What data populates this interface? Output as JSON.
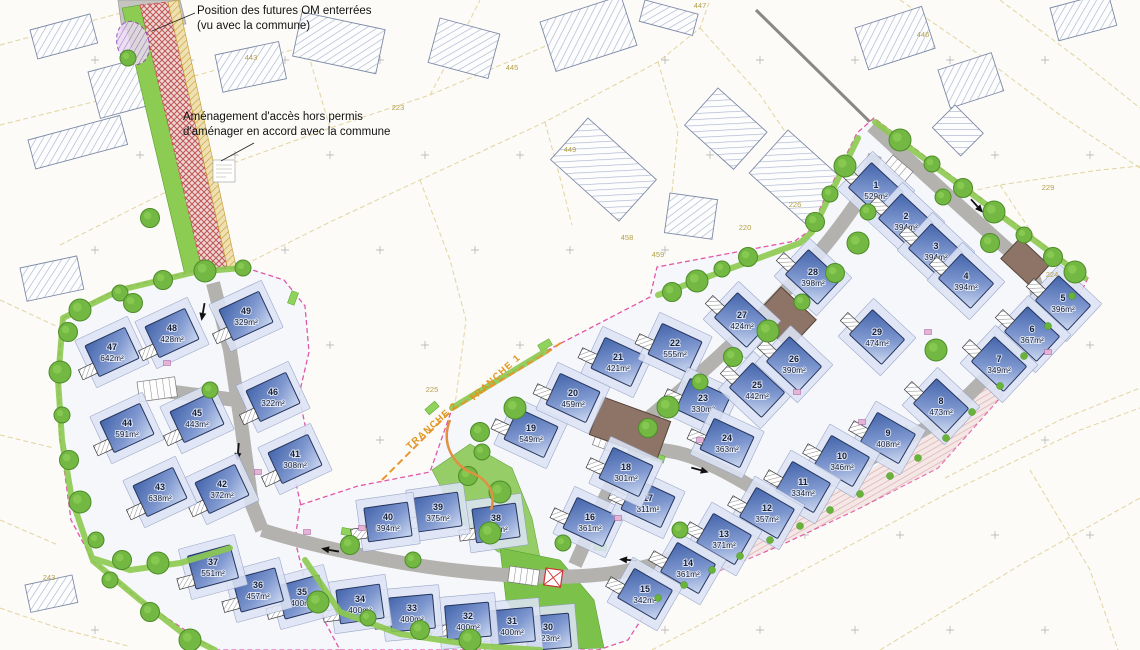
{
  "annotations": {
    "om_line1": "Position des futures OM enterrées",
    "om_line2": "(vu avec la commune)",
    "access_line1": "Aménagement d'accès hors permis",
    "access_line2": "d'aménager en accord avec la commune"
  },
  "area_unit": "m²",
  "tranches": [
    {
      "label": "TRANCHE 1",
      "x": 497,
      "y": 380,
      "rot": -42
    },
    {
      "label": "TRANCHE 2",
      "x": 434,
      "y": 428,
      "rot": -42
    }
  ],
  "lots": [
    {
      "n": 1,
      "area": 529,
      "x": 876,
      "y": 190,
      "r": 43
    },
    {
      "n": 2,
      "area": 394,
      "x": 906,
      "y": 221,
      "r": 43
    },
    {
      "n": 3,
      "area": 394,
      "x": 936,
      "y": 251,
      "r": 43
    },
    {
      "n": 4,
      "area": 394,
      "x": 966,
      "y": 281,
      "r": 43
    },
    {
      "n": 5,
      "area": 396,
      "x": 1063,
      "y": 303,
      "r": 43
    },
    {
      "n": 6,
      "area": 367,
      "x": 1032,
      "y": 334,
      "r": 43
    },
    {
      "n": 7,
      "area": 349,
      "x": 999,
      "y": 364,
      "r": 43
    },
    {
      "n": 8,
      "area": 473,
      "x": 941,
      "y": 406,
      "r": 43
    },
    {
      "n": 9,
      "area": 408,
      "x": 888,
      "y": 438,
      "r": 30
    },
    {
      "n": 10,
      "area": 346,
      "x": 842,
      "y": 461,
      "r": 30
    },
    {
      "n": 11,
      "area": 334,
      "x": 803,
      "y": 487,
      "r": 30
    },
    {
      "n": 12,
      "area": 357,
      "x": 767,
      "y": 513,
      "r": 30
    },
    {
      "n": 13,
      "area": 371,
      "x": 724,
      "y": 539,
      "r": 30
    },
    {
      "n": 14,
      "area": 361,
      "x": 688,
      "y": 568,
      "r": 30
    },
    {
      "n": 15,
      "area": 342,
      "x": 645,
      "y": 594,
      "r": 30
    },
    {
      "n": 16,
      "area": 361,
      "x": 590,
      "y": 522,
      "r": 25
    },
    {
      "n": 17,
      "area": 311,
      "x": 648,
      "y": 503,
      "r": 25
    },
    {
      "n": 18,
      "area": 301,
      "x": 626,
      "y": 472,
      "r": 25
    },
    {
      "n": 19,
      "area": 549,
      "x": 531,
      "y": 433,
      "r": 25
    },
    {
      "n": 20,
      "area": 459,
      "x": 573,
      "y": 398,
      "r": 25
    },
    {
      "n": 21,
      "area": 421,
      "x": 618,
      "y": 362,
      "r": 25
    },
    {
      "n": 22,
      "area": 555,
      "x": 675,
      "y": 348,
      "r": 25
    },
    {
      "n": 23,
      "area": 330,
      "x": 703,
      "y": 403,
      "r": 25
    },
    {
      "n": 24,
      "area": 363,
      "x": 727,
      "y": 443,
      "r": 25
    },
    {
      "n": 25,
      "area": 442,
      "x": 757,
      "y": 390,
      "r": 43
    },
    {
      "n": 26,
      "area": 390,
      "x": 794,
      "y": 364,
      "r": 43
    },
    {
      "n": 27,
      "area": 424,
      "x": 742,
      "y": 320,
      "r": 43
    },
    {
      "n": 28,
      "area": 398,
      "x": 813,
      "y": 277,
      "r": 43
    },
    {
      "n": 29,
      "area": 474,
      "x": 877,
      "y": 337,
      "r": 43
    },
    {
      "n": 30,
      "area": 423,
      "x": 548,
      "y": 632,
      "r": -5
    },
    {
      "n": 31,
      "area": 400,
      "x": 512,
      "y": 626,
      "r": -5
    },
    {
      "n": 32,
      "area": 400,
      "x": 468,
      "y": 621,
      "r": -5
    },
    {
      "n": 33,
      "area": 400,
      "x": 412,
      "y": 613,
      "r": -5
    },
    {
      "n": 34,
      "area": 400,
      "x": 360,
      "y": 604,
      "r": -8
    },
    {
      "n": 35,
      "area": 400,
      "x": 302,
      "y": 597,
      "r": -15
    },
    {
      "n": 36,
      "area": 457,
      "x": 258,
      "y": 590,
      "r": -15
    },
    {
      "n": 37,
      "area": 551,
      "x": 213,
      "y": 567,
      "r": -15
    },
    {
      "n": 38,
      "area": 432,
      "x": 496,
      "y": 523,
      "r": -8
    },
    {
      "n": 39,
      "area": 375,
      "x": 438,
      "y": 512,
      "r": -8
    },
    {
      "n": 40,
      "area": 394,
      "x": 388,
      "y": 522,
      "r": -8
    },
    {
      "n": 41,
      "area": 308,
      "x": 295,
      "y": 459,
      "r": -25
    },
    {
      "n": 42,
      "area": 372,
      "x": 222,
      "y": 489,
      "r": -25
    },
    {
      "n": 43,
      "area": 638,
      "x": 160,
      "y": 492,
      "r": -25
    },
    {
      "n": 44,
      "area": 591,
      "x": 127,
      "y": 428,
      "r": -25
    },
    {
      "n": 45,
      "area": 443,
      "x": 197,
      "y": 418,
      "r": -25
    },
    {
      "n": 46,
      "area": 322,
      "x": 273,
      "y": 397,
      "r": -25
    },
    {
      "n": 47,
      "area": 642,
      "x": 112,
      "y": 352,
      "r": -25
    },
    {
      "n": 48,
      "area": 428,
      "x": 172,
      "y": 333,
      "r": -25
    },
    {
      "n": 49,
      "area": 329,
      "x": 246,
      "y": 316,
      "r": -25
    }
  ],
  "parcels": [
    {
      "label": "443",
      "x": 251,
      "y": 60
    },
    {
      "label": "223",
      "x": 398,
      "y": 110
    },
    {
      "label": "445",
      "x": 512,
      "y": 70
    },
    {
      "label": "449",
      "x": 570,
      "y": 152
    },
    {
      "label": "458",
      "x": 627,
      "y": 240
    },
    {
      "label": "459",
      "x": 658,
      "y": 257
    },
    {
      "label": "447",
      "x": 700,
      "y": 8
    },
    {
      "label": "220",
      "x": 745,
      "y": 230
    },
    {
      "label": "226",
      "x": 795,
      "y": 207
    },
    {
      "label": "446",
      "x": 923,
      "y": 37
    },
    {
      "label": "229",
      "x": 1048,
      "y": 190
    },
    {
      "label": "224",
      "x": 1052,
      "y": 277
    },
    {
      "label": "225",
      "x": 432,
      "y": 392
    },
    {
      "label": "243",
      "x": 49,
      "y": 580
    }
  ],
  "colors": {
    "house_blue": "#4465ab",
    "road_grey": "#b4b2ae",
    "vegetation_green": "#8cc94e",
    "boundary_pink": "#e058a8",
    "tranche_orange": "#e8962e",
    "garden_red": "#cf6f6f"
  }
}
